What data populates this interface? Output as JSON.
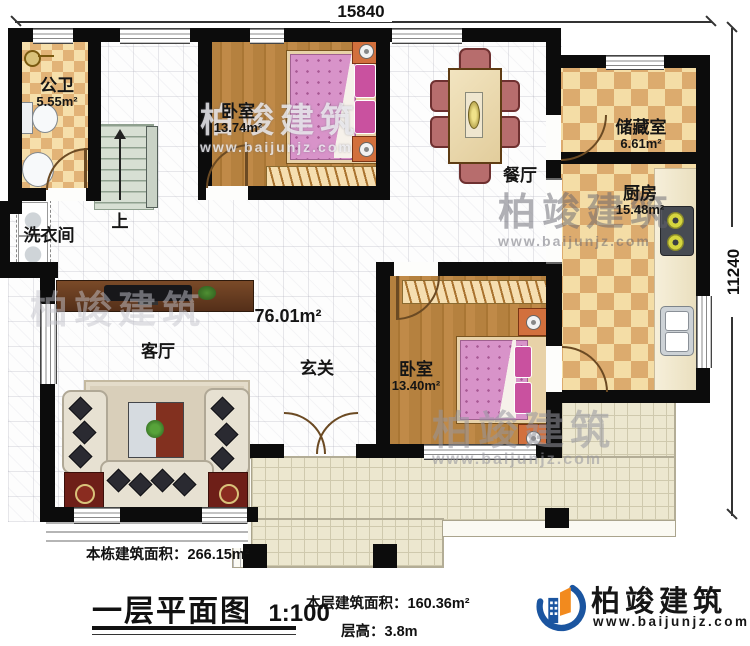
{
  "plan": {
    "dimensions": {
      "width_label": "15840",
      "depth_label": "11240"
    },
    "rooms": {
      "bathroom": {
        "name": "公卫",
        "area": "5.55m²"
      },
      "bedroom_top": {
        "name": "卧室",
        "area": "13.74m²"
      },
      "dining": {
        "name": "餐厅"
      },
      "storage": {
        "name": "储藏室",
        "area": "6.61m²"
      },
      "kitchen": {
        "name": "厨房",
        "area": "15.48m²"
      },
      "laundry": {
        "name": "洗衣间"
      },
      "stairs_up": {
        "label": "上"
      },
      "living": {
        "name": "客厅"
      },
      "foyer": {
        "name": "玄关"
      },
      "bedroom_bottom": {
        "name": "卧室",
        "area": "13.40m²"
      },
      "level_area": {
        "label": "76.01m²"
      }
    }
  },
  "title_block": {
    "building_area": "本栋建筑面积：266.15m²",
    "plan_name": "一层平面图",
    "scale": "1:100",
    "floor_area": "本层建筑面积：160.36m²",
    "floor_height": "层高：3.8m"
  },
  "brand": {
    "name": "柏竣建筑",
    "website": "www.baijunjz.com"
  },
  "colors": {
    "wall": "#0c0c0c",
    "wood_floor": "#b5813f",
    "tile_dark": "#dcab6e",
    "tile_light": "#f4dda6",
    "terrace": "#ece7cf",
    "bed": "#d893c9",
    "logo_blue": "#1b55a0",
    "logo_orange": "#f28a1e"
  }
}
